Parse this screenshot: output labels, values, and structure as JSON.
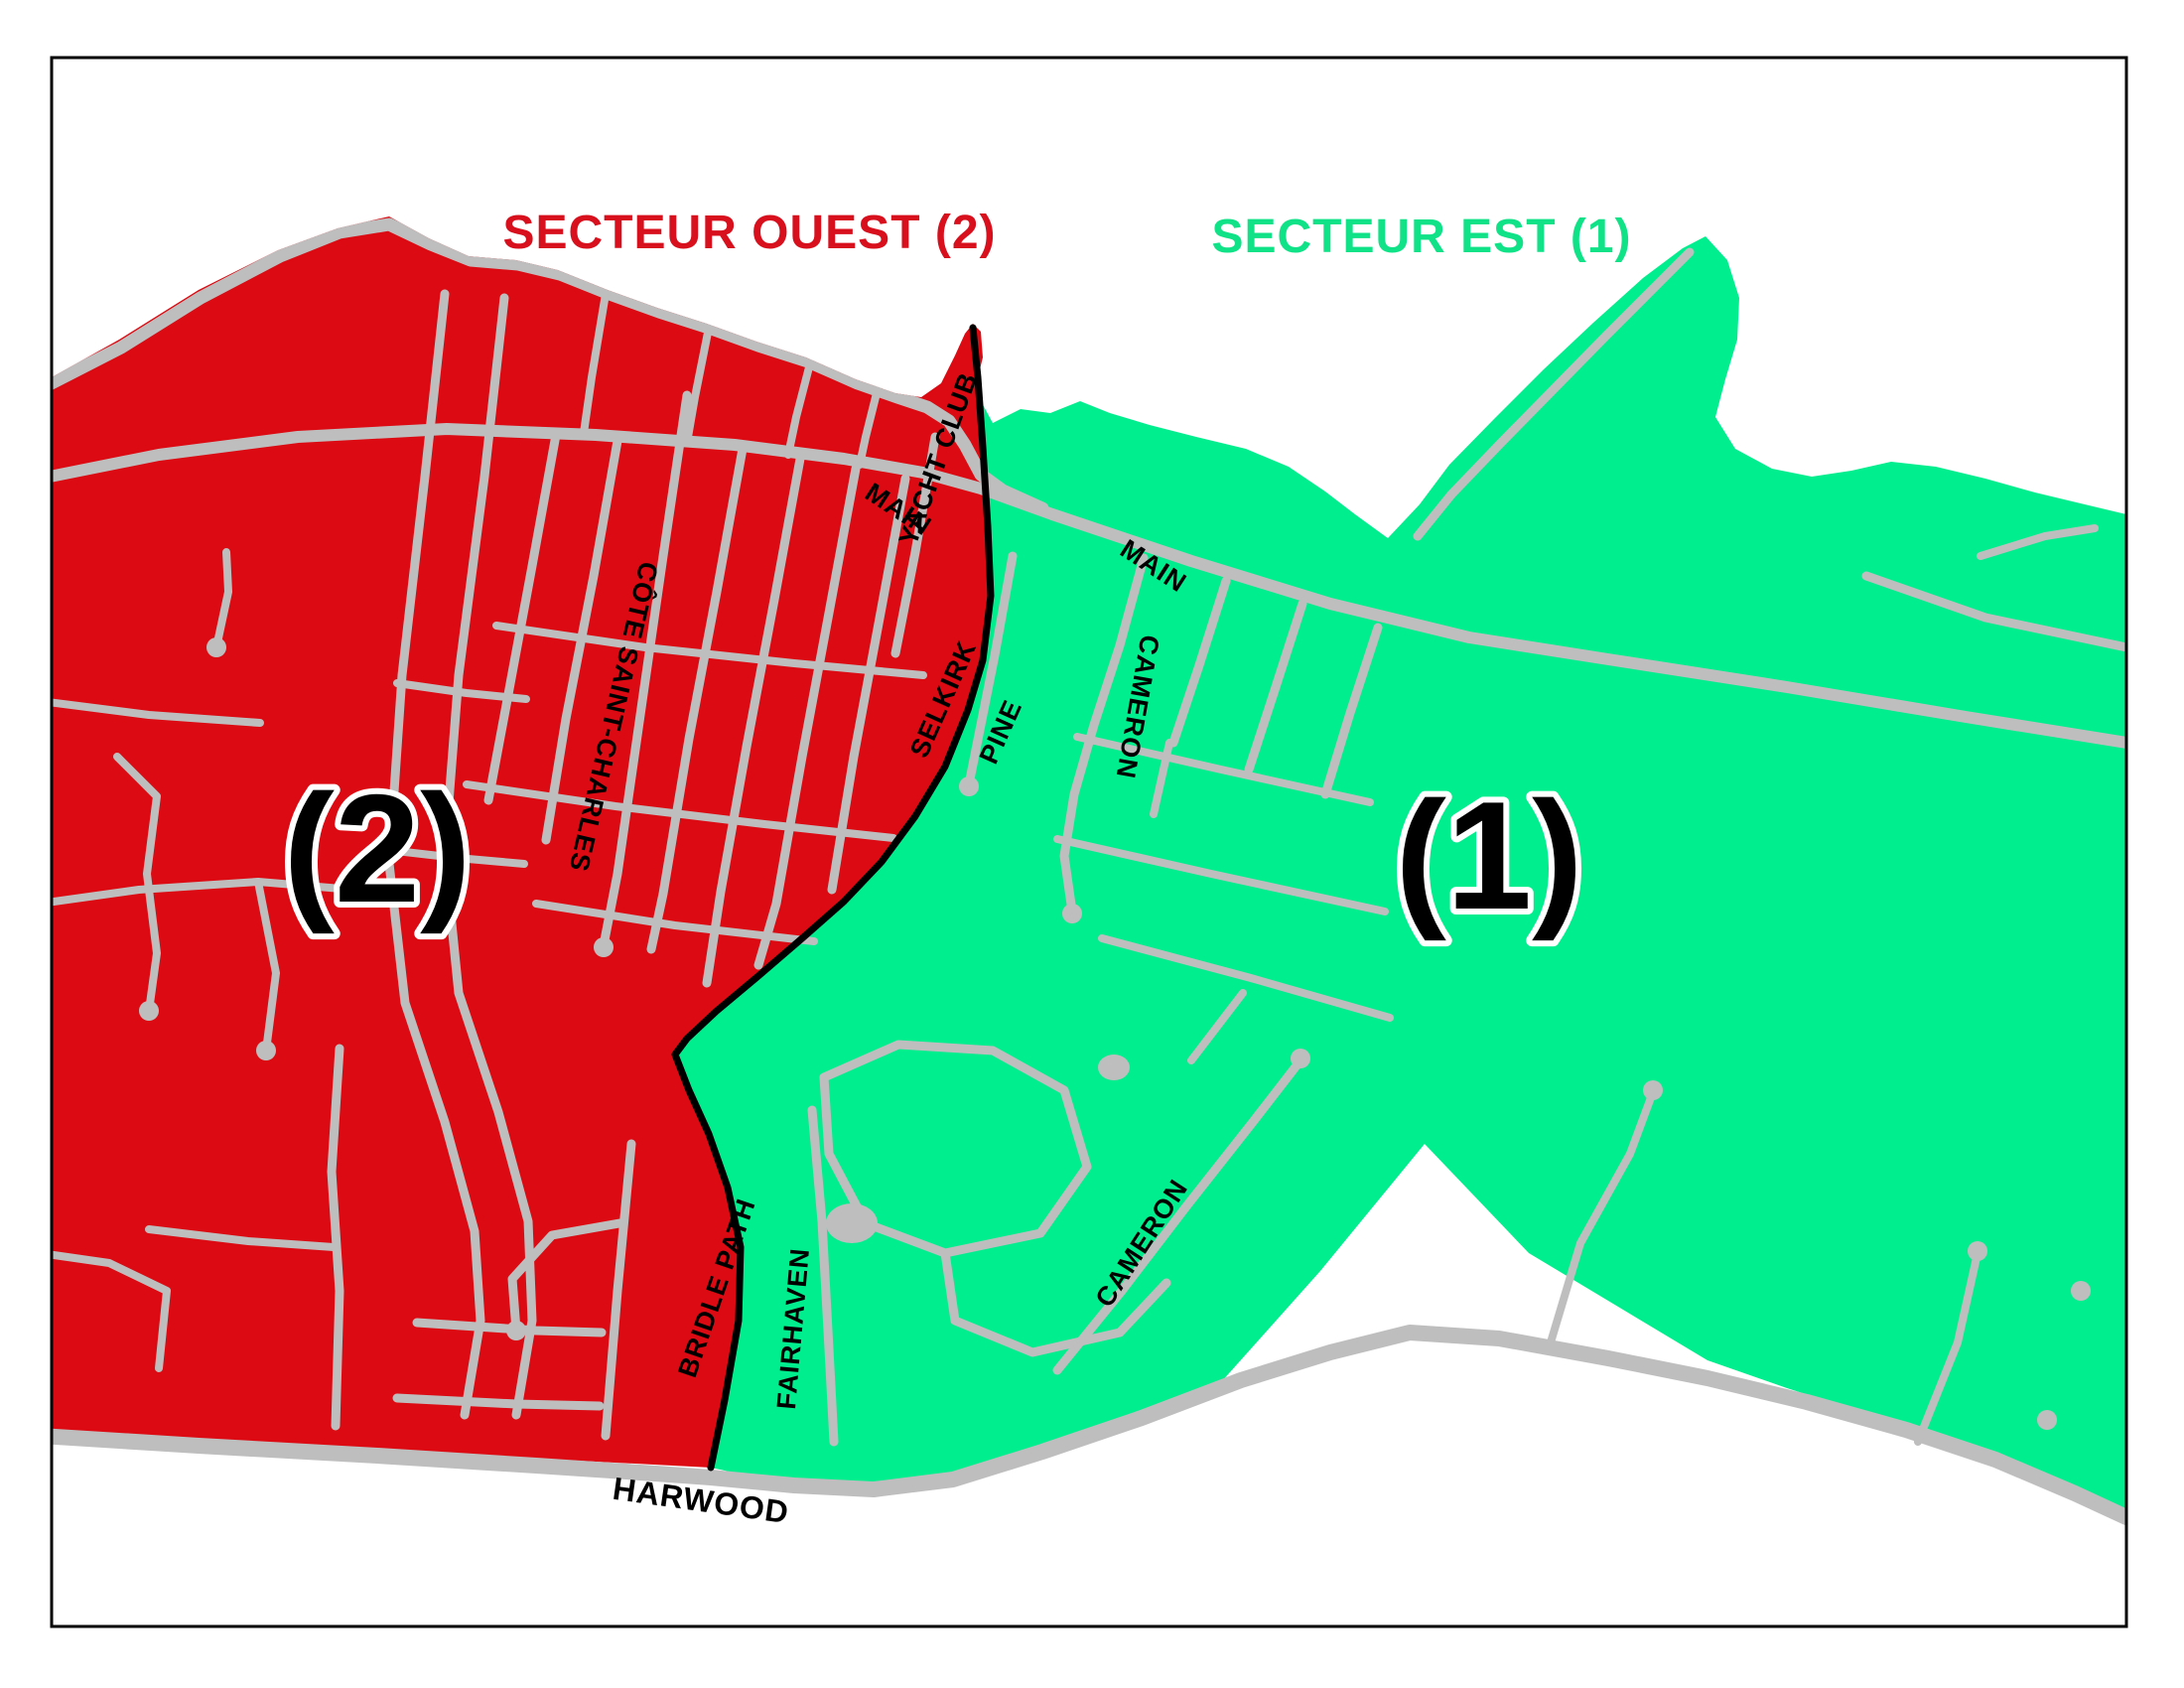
{
  "colors": {
    "sector-west": "#DC0A12",
    "sector-east": "#00EE8E",
    "title-west": "#D8101E",
    "title-east": "#10E287",
    "road": "#BEBEBE",
    "boundary": "#000000",
    "frame": "#000000",
    "label": "#000000"
  },
  "titles": {
    "west": "SECTEUR OUEST (2)",
    "east": "SECTEUR EST (1)"
  },
  "sectors": {
    "west": {
      "name": "SECTEUR OUEST",
      "number": "(2)"
    },
    "east": {
      "name": "SECTEUR EST",
      "number": "(1)"
    }
  },
  "streets": {
    "main_west": "MAIN",
    "yacht_club": "YACHT CLUB",
    "selkirk": "SELKIRK",
    "cote_saint_charles": "CÔTE SAINT-CHARLES",
    "main_east": "MAIN",
    "pine": "PINE",
    "cameron_north": "CAMERON",
    "cameron_south": "CAMERON",
    "bridle_path": "BRIDLE PATH",
    "fairhaven": "FAIRHAVEN",
    "harwood": "HARWOOD"
  }
}
